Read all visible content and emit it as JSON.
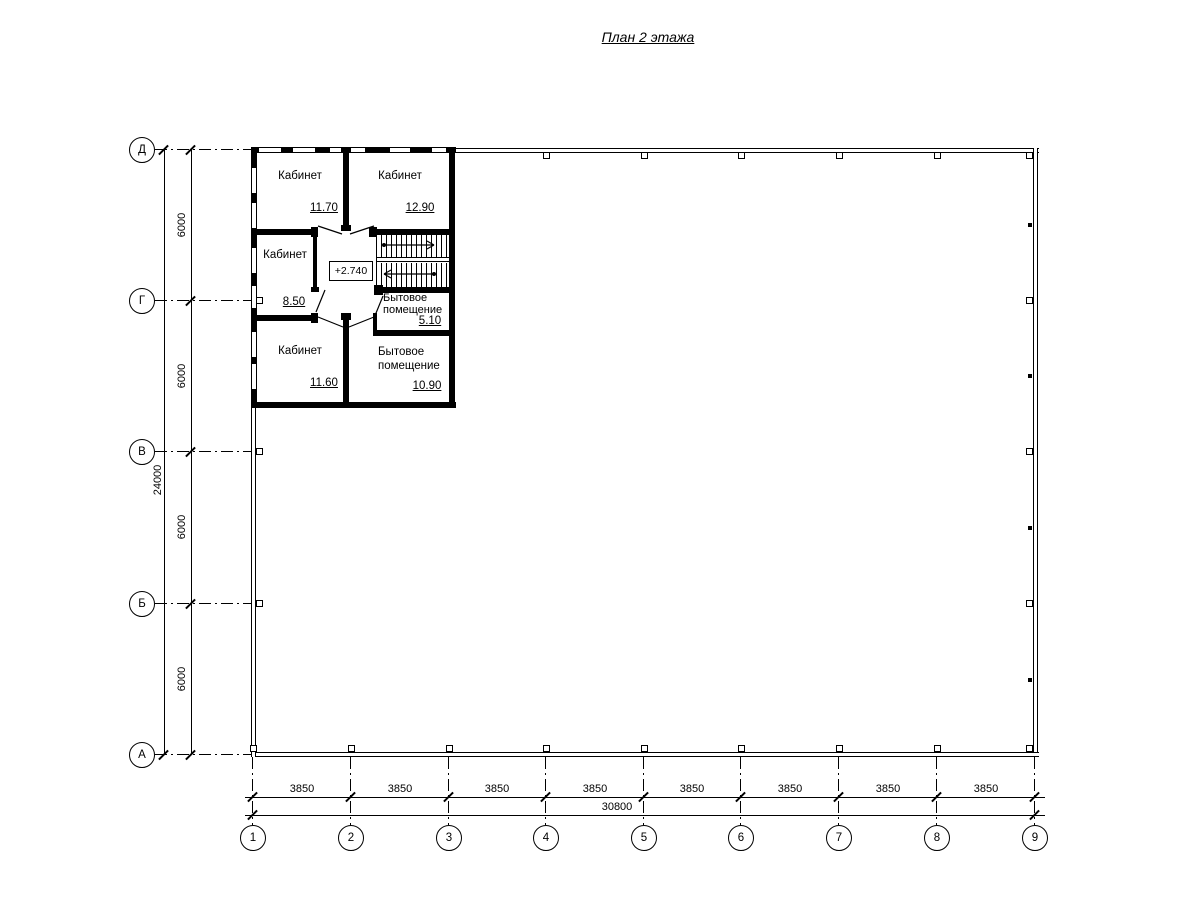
{
  "title": "План 2 этажа",
  "level_mark": "+2.740",
  "rooms": [
    {
      "name": "Кабинет",
      "area": "11.70"
    },
    {
      "name": "Кабинет",
      "area": "12.90"
    },
    {
      "name": "Кабинет",
      "area": "8.50"
    },
    {
      "name": "Кабинет",
      "area": "11.60"
    },
    {
      "name": "Бытовое помещение",
      "area": "5.10"
    },
    {
      "name": "Бытовое помещение",
      "area": "10.90"
    }
  ],
  "grid": {
    "rows": [
      "Д",
      "Г",
      "В",
      "Б",
      "А"
    ],
    "cols": [
      "1",
      "2",
      "3",
      "4",
      "5",
      "6",
      "7",
      "8",
      "9"
    ]
  },
  "dimensions": {
    "vertical_segments": [
      "6000",
      "6000",
      "6000",
      "6000"
    ],
    "vertical_total": "24000",
    "horizontal_segments": [
      "3850",
      "3850",
      "3850",
      "3850",
      "3850",
      "3850",
      "3850",
      "3850"
    ],
    "horizontal_total": "30800"
  }
}
